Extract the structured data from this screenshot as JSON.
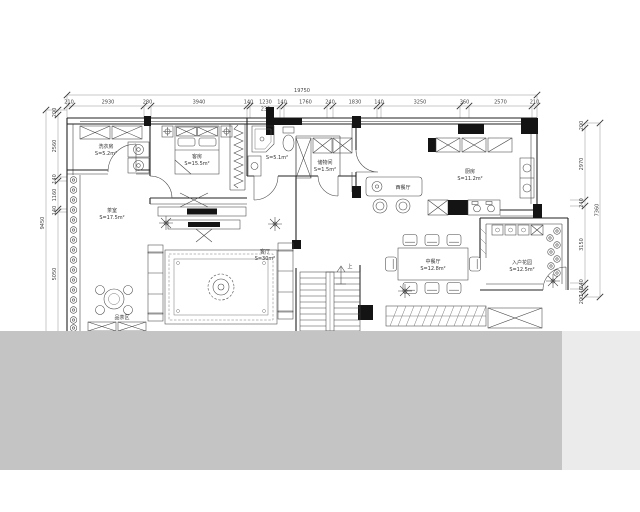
{
  "dims": {
    "top_total": "19750",
    "top_segments": [
      "210",
      "2930",
      "280",
      "3940",
      "140",
      "1230",
      "140",
      "1760",
      "240",
      "1830",
      "140",
      "3250",
      "360",
      "2570",
      "210"
    ],
    "top_sub": "232",
    "left_total": "9450",
    "left_segments": [
      "200",
      "2560",
      "140",
      "1160",
      "140",
      "5050"
    ],
    "right_total": "7360",
    "right_segments": [
      "200",
      "2970",
      "240",
      "3150",
      "240",
      "140",
      "200"
    ]
  },
  "rooms": {
    "laundry": {
      "name": "洗衣房",
      "area": "S=5.2m²"
    },
    "guest_room": {
      "name": "客房",
      "area": "S=15.5m²"
    },
    "bathroom": {
      "area": "S=5.1m²"
    },
    "storage": {
      "name": "储物间",
      "area": "S=1.5m²"
    },
    "kitchen": {
      "name": "厨房",
      "area": "S=11.2m²"
    },
    "bar": {
      "name": "西餐厅"
    },
    "living_room": {
      "name": "客厅",
      "area": "S=30m²"
    },
    "tea_room": {
      "name": "茶室",
      "area": "S=17.5m²"
    },
    "tea_area": {
      "name": "品茶区"
    },
    "dining": {
      "name": "中餐厅",
      "area": "S=12.8m²"
    },
    "entry_garden": {
      "name": "入户花园",
      "area": "S=12.5m²"
    },
    "stairs": {
      "label": "上"
    }
  },
  "colors": {
    "ink": "#222222",
    "censor": "#c4c4c4",
    "censor_light": "#ebebeb",
    "background": "#ffffff"
  }
}
